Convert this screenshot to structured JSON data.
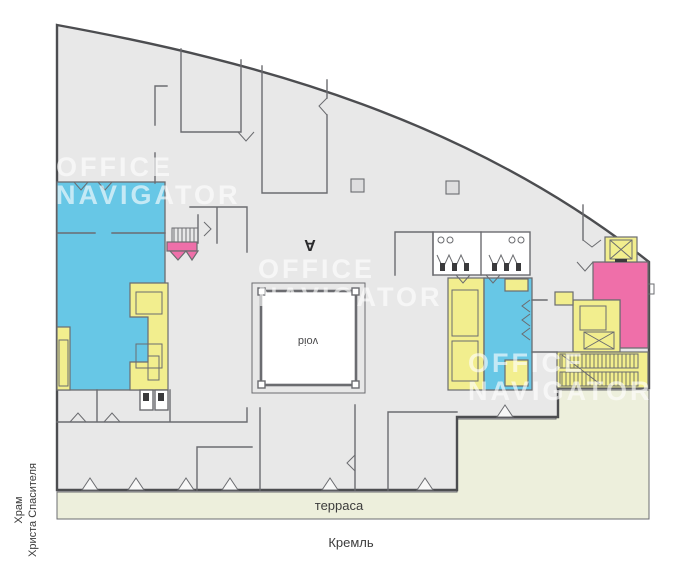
{
  "labels": {
    "void": "void",
    "section_marker": "A",
    "terrace": "терраса",
    "street_bottom": "Кремль",
    "landmark_left_line1": "Храм",
    "landmark_left_line2": "Христа Спасителя"
  },
  "watermark": {
    "line1": "OFFICE",
    "line2": "NAVIGATOR"
  },
  "colors": {
    "floor": "#e8e8e8",
    "wall_dark": "#4c4d50",
    "wall_light": "#6b6c70",
    "zone_cyan": "#67c7e6",
    "zone_yellow": "#f2ee8e",
    "zone_pink": "#ef6fa9",
    "zone_terrace": "#edefdc",
    "fixture": "#3a3a3c",
    "watermark": "#ffffff",
    "text": "#3c3c3c"
  }
}
